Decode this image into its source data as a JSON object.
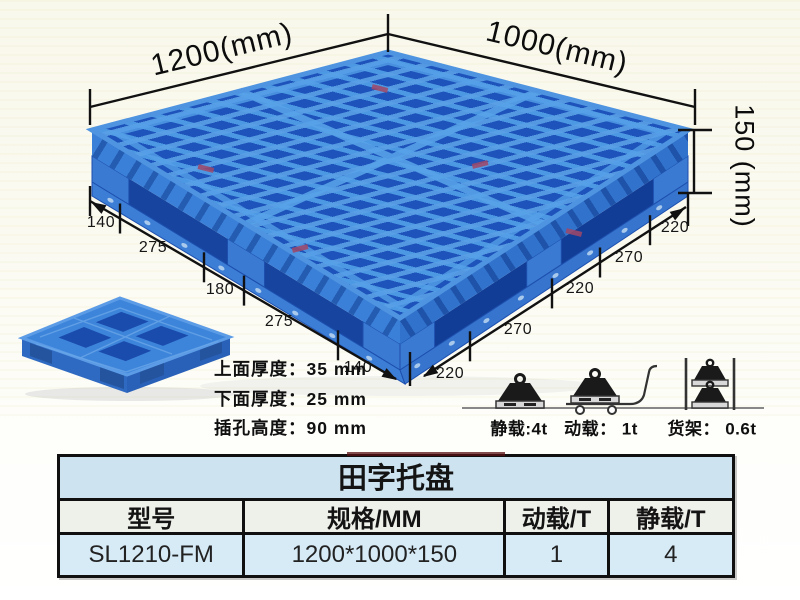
{
  "diagram": {
    "dim_width": "1200(mm)",
    "dim_depth": "1000(mm)",
    "dim_height": "150 (mm)",
    "left_chain": [
      "140",
      "275",
      "180",
      "275",
      "140"
    ],
    "right_chain": [
      "220",
      "270",
      "220",
      "270",
      "220"
    ],
    "specs": [
      {
        "label": "上面厚度：",
        "value": "35 mm"
      },
      {
        "label": "下面厚度：",
        "value": "25 mm"
      },
      {
        "label": "插孔高度：",
        "value": "90 mm"
      }
    ],
    "load_ratings": [
      {
        "icon": "static-load-icon",
        "label": "静载:4t"
      },
      {
        "icon": "dynamic-load-icon",
        "label": "动载： 1t"
      },
      {
        "icon": "rack-load-icon",
        "label": "货架： 0.6t"
      }
    ]
  },
  "table": {
    "title": "田字托盘",
    "headers": [
      "型号",
      "规格/MM",
      "动载/T",
      "静载/T"
    ],
    "rows": [
      [
        "SL1210-FM",
        "1200*1000*150",
        "1",
        "4"
      ]
    ]
  },
  "colors": {
    "pallet_blue": "#2e72cc",
    "pallet_dark": "#1d53ba",
    "pallet_light": "#4d98e2",
    "table_blue": "#cde3f0",
    "background": "#fbfaf1"
  }
}
